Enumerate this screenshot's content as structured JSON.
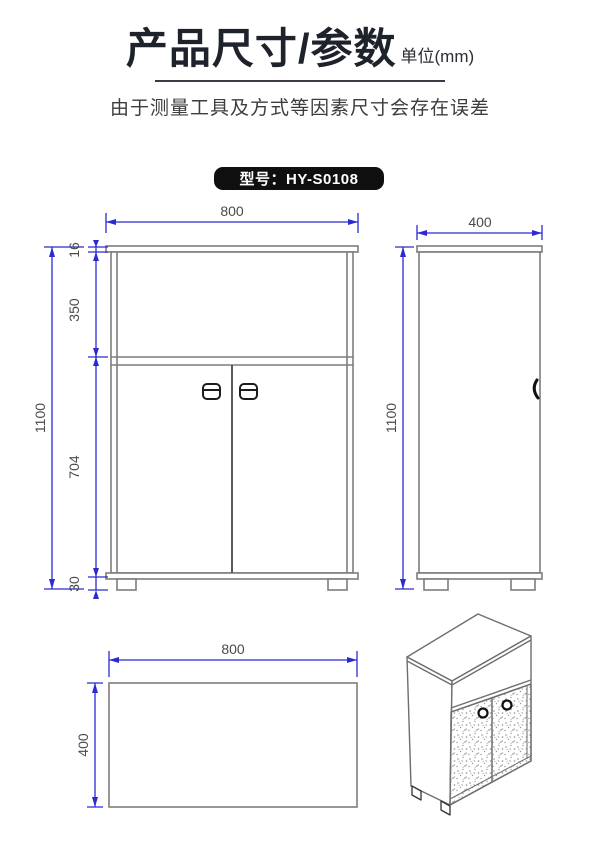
{
  "header": {
    "title": "产品尺寸/参数",
    "unit": "单位(mm)",
    "subtitle": "由于测量工具及方式等因素尺寸会存在误差"
  },
  "model": {
    "text": "型号：HY-S0108"
  },
  "dimensions": {
    "front": {
      "width": "800",
      "height": "1100",
      "top_panel": "16",
      "shelf_section": "350",
      "door_section": "704",
      "feet": "30"
    },
    "side": {
      "width": "400",
      "height": "1100"
    },
    "top": {
      "width": "800",
      "depth": "400"
    }
  },
  "colors": {
    "dimension_line": "#2a2ad2",
    "outline_gray": "#7d7d7d",
    "dimension_text": "#4a4a4a",
    "badge_background": "#0f0f0f",
    "badge_text": "#ffffff",
    "title_text": "#1e222b"
  }
}
